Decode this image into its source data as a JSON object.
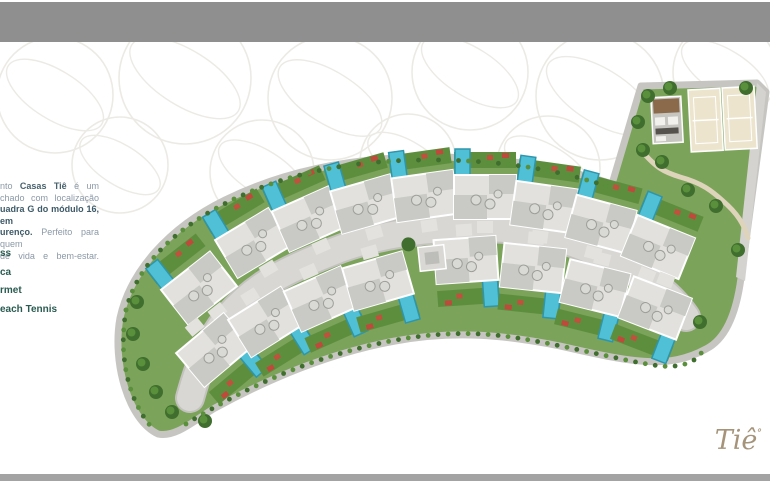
{
  "bars": {
    "top_color": "#8f8f8f",
    "bottom_color": "#a3a3a3"
  },
  "intro": {
    "l1a": "nto ",
    "l1b": "Casas Tiê",
    "l1c": " é um",
    "l2": "chado com localização",
    "l3": "uadra G do módulo 16, em",
    "l4a": "urenço.",
    "l4b": " Perfeito para quem",
    "l5": "de vida e bem-estar."
  },
  "amenities": {
    "items": [
      "ss",
      "ca",
      "rmet",
      "each Tennis"
    ]
  },
  "logo": {
    "text": "Tiê"
  },
  "site_plan": {
    "colors": {
      "band_green": "#7ba35a",
      "sidewalk": "#c6c5c1",
      "road": "#d8d7d3",
      "road_curb": "#c3c2be",
      "roof": "#e2e1de",
      "roof_dark": "#c9c9c5",
      "roof_vent": "#d9d9d6",
      "pool": "#4fc0d5",
      "pool_dark": "#2e96ac",
      "garden": "#5d8e3e",
      "flower": "#c0523d",
      "sand": "#ece4cd",
      "walk_path": "#ddd4bb",
      "marker_red": "#bf4a3c",
      "tree_dark": "#3f6e2e",
      "tree_light": "#5a8f3c",
      "pattern_line": "#eceae4",
      "edge_road": "#d4d3cf"
    },
    "houses_top": [
      [
        199,
        288,
        -38
      ],
      [
        253,
        243,
        -31
      ],
      [
        309,
        219,
        -24
      ],
      [
        366,
        204,
        -16
      ],
      [
        425,
        196,
        -8
      ],
      [
        485,
        197,
        0
      ],
      [
        544,
        207,
        8
      ],
      [
        601,
        224,
        15
      ],
      [
        658,
        247,
        22
      ]
    ],
    "houses_bottom": [
      [
        214,
        350,
        -40
      ],
      [
        266,
        322,
        -32
      ],
      [
        321,
        299,
        -24
      ],
      [
        378,
        281,
        -16
      ],
      [
        466,
        260,
        -4
      ],
      [
        533,
        268,
        6
      ],
      [
        595,
        288,
        14
      ],
      [
        655,
        308,
        21
      ]
    ],
    "gatehouse": [
      432,
      258,
      -6
    ],
    "courts": [
      [
        688,
        90
      ],
      [
        722,
        88
      ]
    ],
    "trees": [
      [
        137,
        302
      ],
      [
        133,
        334
      ],
      [
        143,
        364
      ],
      [
        156,
        392
      ],
      [
        172,
        412
      ],
      [
        205,
        421
      ],
      [
        648,
        96
      ],
      [
        670,
        88
      ],
      [
        746,
        88
      ],
      [
        638,
        122
      ],
      [
        643,
        150
      ],
      [
        662,
        162
      ],
      [
        688,
        190
      ],
      [
        716,
        206
      ],
      [
        738,
        250
      ],
      [
        700,
        322
      ]
    ],
    "pattern_circles": [
      [
        55,
        95,
        58
      ],
      [
        185,
        78,
        66
      ],
      [
        330,
        98,
        62
      ],
      [
        470,
        72,
        58
      ],
      [
        600,
        96,
        64
      ],
      [
        725,
        72,
        52
      ],
      [
        120,
        165,
        48
      ],
      [
        262,
        172,
        52
      ],
      [
        408,
        162,
        48
      ],
      [
        548,
        168,
        52
      ],
      [
        688,
        162,
        48
      ]
    ]
  }
}
